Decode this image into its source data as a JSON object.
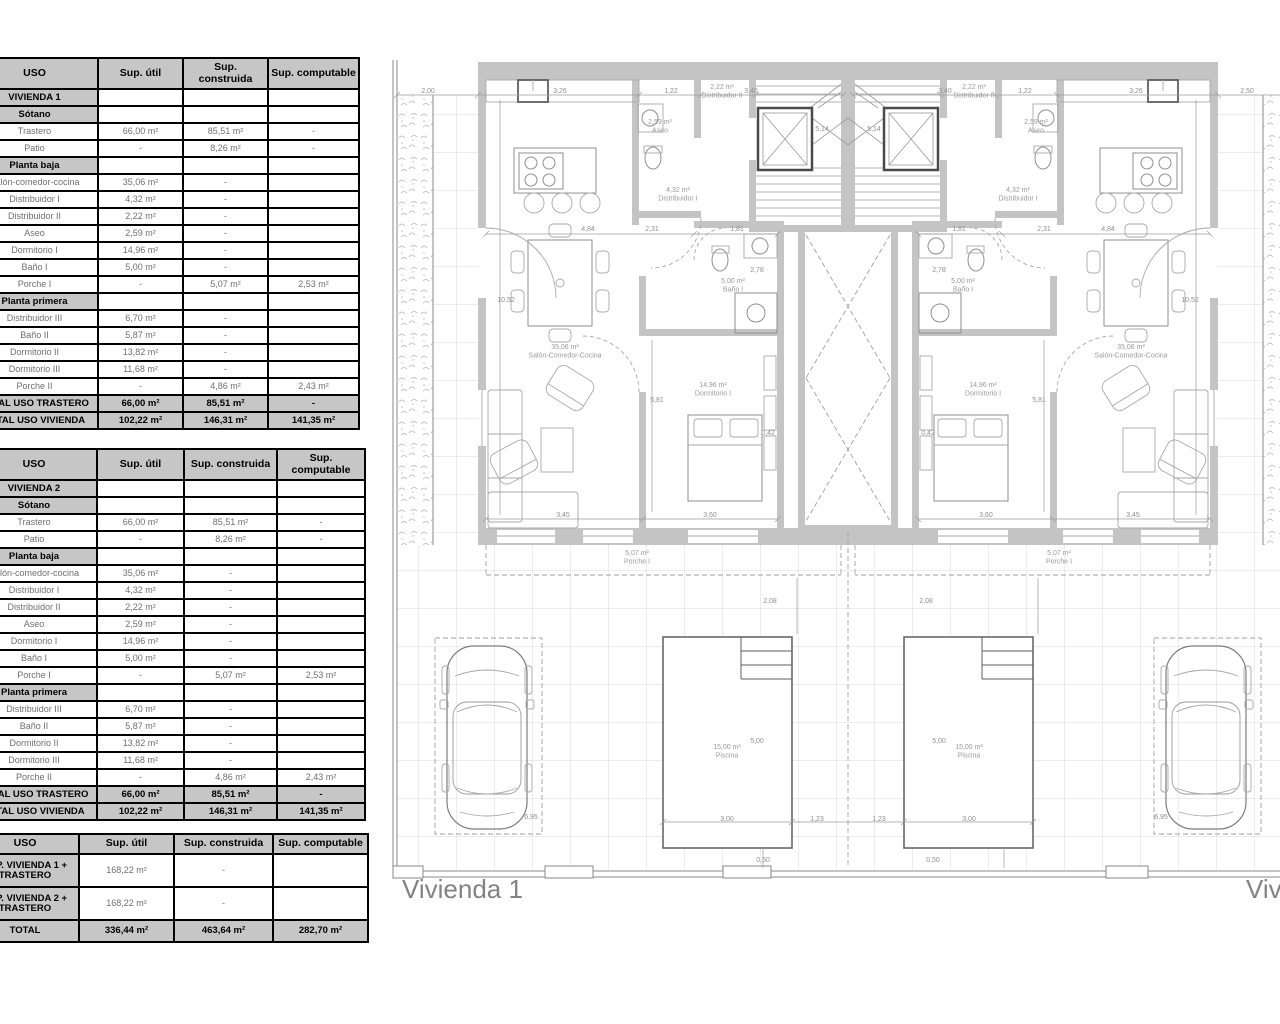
{
  "tables": {
    "headers": [
      "USO",
      "Sup. útil",
      "Sup. construida",
      "Sup. computable"
    ],
    "vivienda1": {
      "rows": [
        {
          "type": "title",
          "label": "VIVIENDA 1",
          "util": "",
          "construida": "",
          "computable": ""
        },
        {
          "type": "section",
          "label": "Sótano",
          "util": "",
          "construida": "",
          "computable": ""
        },
        {
          "type": "data",
          "label": "Trastero",
          "util": "66,00 m²",
          "construida": "85,51 m²",
          "computable": "-"
        },
        {
          "type": "data",
          "label": "Patio",
          "util": "-",
          "construida": "8,26 m²",
          "computable": "-"
        },
        {
          "type": "section",
          "label": "Planta baja",
          "util": "",
          "construida": "",
          "computable": ""
        },
        {
          "type": "data",
          "label": "Salón-comedor-cocina",
          "util": "35,06 m²",
          "construida": "-",
          "computable": ""
        },
        {
          "type": "data",
          "label": "Distribuidor I",
          "util": "4,32 m²",
          "construida": "-",
          "computable": ""
        },
        {
          "type": "data",
          "label": "Distribuidor II",
          "util": "2,22 m²",
          "construida": "-",
          "computable": ""
        },
        {
          "type": "data",
          "label": "Aseo",
          "util": "2,59 m²",
          "construida": "-",
          "computable": ""
        },
        {
          "type": "data",
          "label": "Dormitorio I",
          "util": "14,96 m²",
          "construida": "-",
          "computable": ""
        },
        {
          "type": "data",
          "label": "Baño I",
          "util": "5,00 m²",
          "construida": "-",
          "computable": ""
        },
        {
          "type": "data",
          "label": "Porche I",
          "util": "-",
          "construida": "5,07 m²",
          "computable": "2,53 m²"
        },
        {
          "type": "section",
          "label": "Planta primera",
          "util": "",
          "construida": "",
          "computable": ""
        },
        {
          "type": "data",
          "label": "Distribuidor III",
          "util": "6,70 m²",
          "construida": "-",
          "computable": ""
        },
        {
          "type": "data",
          "label": "Baño II",
          "util": "5,87 m²",
          "construida": "-",
          "computable": ""
        },
        {
          "type": "data",
          "label": "Dormitorio II",
          "util": "13,82 m²",
          "construida": "-",
          "computable": ""
        },
        {
          "type": "data",
          "label": "Dormitorio III",
          "util": "11,68 m²",
          "construida": "-",
          "computable": ""
        },
        {
          "type": "data",
          "label": "Porche II",
          "util": "-",
          "construida": "4,86 m²",
          "computable": "2,43 m²"
        },
        {
          "type": "total",
          "label": "TOTAL USO TRASTERO",
          "util": "66,00 m²",
          "construida": "85,51 m²",
          "computable": "-"
        },
        {
          "type": "total",
          "label": "TOTAL USO VIVIENDA",
          "util": "102,22 m²",
          "construida": "146,31 m²",
          "computable": "141,35 m²"
        }
      ]
    },
    "vivienda2": {
      "rows": [
        {
          "type": "title",
          "label": "VIVIENDA 2",
          "util": "",
          "construida": "",
          "computable": ""
        },
        {
          "type": "section",
          "label": "Sótano",
          "util": "",
          "construida": "",
          "computable": ""
        },
        {
          "type": "data",
          "label": "Trastero",
          "util": "66,00 m²",
          "construida": "85,51 m²",
          "computable": "-"
        },
        {
          "type": "data",
          "label": "Patio",
          "util": "-",
          "construida": "8,26 m²",
          "computable": "-"
        },
        {
          "type": "section",
          "label": "Planta baja",
          "util": "",
          "construida": "",
          "computable": ""
        },
        {
          "type": "data",
          "label": "Salón-comedor-cocina",
          "util": "35,06 m²",
          "construida": "-",
          "computable": ""
        },
        {
          "type": "data",
          "label": "Distribuidor I",
          "util": "4,32 m²",
          "construida": "-",
          "computable": ""
        },
        {
          "type": "data",
          "label": "Distribuidor II",
          "util": "2,22 m²",
          "construida": "-",
          "computable": ""
        },
        {
          "type": "data",
          "label": "Aseo",
          "util": "2,59 m²",
          "construida": "-",
          "computable": ""
        },
        {
          "type": "data",
          "label": "Dormitorio I",
          "util": "14,96 m²",
          "construida": "-",
          "computable": ""
        },
        {
          "type": "data",
          "label": "Baño I",
          "util": "5,00 m²",
          "construida": "-",
          "computable": ""
        },
        {
          "type": "data",
          "label": "Porche I",
          "util": "-",
          "construida": "5,07 m²",
          "computable": "2,53 m²"
        },
        {
          "type": "section",
          "label": "Planta primera",
          "util": "",
          "construida": "",
          "computable": ""
        },
        {
          "type": "data",
          "label": "Distribuidor III",
          "util": "6,70 m²",
          "construida": "-",
          "computable": ""
        },
        {
          "type": "data",
          "label": "Baño II",
          "util": "5,87 m²",
          "construida": "-",
          "computable": ""
        },
        {
          "type": "data",
          "label": "Dormitorio II",
          "util": "13,82 m²",
          "construida": "-",
          "computable": ""
        },
        {
          "type": "data",
          "label": "Dormitorio III",
          "util": "11,68 m²",
          "construida": "-",
          "computable": ""
        },
        {
          "type": "data",
          "label": "Porche II",
          "util": "-",
          "construida": "4,86 m²",
          "computable": "2,43 m²"
        },
        {
          "type": "total",
          "label": "TOTAL USO TRASTERO",
          "util": "66,00 m²",
          "construida": "85,51 m²",
          "computable": "-"
        },
        {
          "type": "total",
          "label": "TOTAL USO VIVIENDA",
          "util": "102,22 m²",
          "construida": "146,31 m²",
          "computable": "141,35 m²"
        }
      ]
    },
    "totals": {
      "rows": [
        {
          "type": "total-label",
          "label": "SUP. VIVIENDA 1 + TRASTERO",
          "util": "168,22 m²",
          "construida": "-",
          "computable": ""
        },
        {
          "type": "total-label",
          "label": "SUP. VIVIENDA 2 + TRASTERO",
          "util": "168,22 m²",
          "construida": "-",
          "computable": ""
        },
        {
          "type": "total",
          "label": "TOTAL",
          "util": "336,44 m²",
          "construida": "463,64  m²",
          "computable": "282,70  m²"
        }
      ]
    }
  },
  "plan": {
    "caption_house1": "Vivienda 1",
    "caption_house2": "Vivienda 2",
    "labels": [
      {
        "t": "2,00",
        "x": 428,
        "y": 93,
        "c": "dim"
      },
      {
        "t": "3,26",
        "x": 560,
        "y": 93,
        "c": "dim"
      },
      {
        "t": "1,22",
        "x": 671,
        "y": 93,
        "c": "dim"
      },
      {
        "t": "2,22 m²\nDistribuidor II",
        "x": 722,
        "y": 89,
        "c": "room",
        "s": 6.5
      },
      {
        "t": "3,40",
        "x": 751,
        "y": 93,
        "c": "dim"
      },
      {
        "t": "5,14",
        "x": 822,
        "y": 131,
        "c": "dim"
      },
      {
        "t": "5,14",
        "x": 874,
        "y": 131,
        "c": "dim"
      },
      {
        "t": "3,40",
        "x": 945,
        "y": 93,
        "c": "dim"
      },
      {
        "t": "2,22 m²\nDistribuidor II",
        "x": 974,
        "y": 89,
        "c": "room",
        "s": 6.5
      },
      {
        "t": "1,22",
        "x": 1025,
        "y": 93,
        "c": "dim"
      },
      {
        "t": "3,26",
        "x": 1136,
        "y": 93,
        "c": "dim"
      },
      {
        "t": "2,50",
        "x": 1247,
        "y": 93,
        "c": "dim"
      },
      {
        "t": "2,59 m²\nAseo",
        "x": 660,
        "y": 124,
        "c": "room",
        "s": 6.5
      },
      {
        "t": "2,59 m²\nAseo",
        "x": 1036,
        "y": 124,
        "c": "room",
        "s": 6.5
      },
      {
        "t": "4,32 m²\nDistribuidor I",
        "x": 678,
        "y": 192,
        "c": "room",
        "s": 6.5
      },
      {
        "t": "4,32 m²\nDistribuidor I",
        "x": 1018,
        "y": 192,
        "c": "room",
        "s": 6.5
      },
      {
        "t": "4,84",
        "x": 588,
        "y": 231,
        "c": "dim"
      },
      {
        "t": "2,31",
        "x": 652,
        "y": 231,
        "c": "dim"
      },
      {
        "t": "1,81",
        "x": 737,
        "y": 231,
        "c": "dim"
      },
      {
        "t": "1,81",
        "x": 959,
        "y": 231,
        "c": "dim"
      },
      {
        "t": "2,31",
        "x": 1044,
        "y": 231,
        "c": "dim"
      },
      {
        "t": "4,84",
        "x": 1108,
        "y": 231,
        "c": "dim"
      },
      {
        "t": "5,00 m²\nBaño I",
        "x": 733,
        "y": 283,
        "c": "room",
        "s": 6.5
      },
      {
        "t": "2,78",
        "x": 757,
        "y": 272,
        "c": "dim",
        "s": 6
      },
      {
        "t": "2,78",
        "x": 939,
        "y": 272,
        "c": "dim",
        "s": 6
      },
      {
        "t": "5,00 m²\nBaño I",
        "x": 963,
        "y": 283,
        "c": "room",
        "s": 6.5
      },
      {
        "t": "10,52",
        "x": 506,
        "y": 302,
        "c": "dim"
      },
      {
        "t": "10,52",
        "x": 1190,
        "y": 302,
        "c": "dim"
      },
      {
        "t": "35,06 m²\nSalón-Comedor-Cocina",
        "x": 565,
        "y": 349,
        "c": "room"
      },
      {
        "t": "35,06 m²\nSalón-Comedor-Cocina",
        "x": 1131,
        "y": 349,
        "c": "room"
      },
      {
        "t": "14,96 m²\nDormitorio I",
        "x": 713,
        "y": 387,
        "c": "room"
      },
      {
        "t": "14,96 m²\nDormitorio I",
        "x": 983,
        "y": 387,
        "c": "room"
      },
      {
        "t": "5,81",
        "x": 657,
        "y": 402,
        "c": "dim"
      },
      {
        "t": "5,81",
        "x": 1039,
        "y": 402,
        "c": "dim"
      },
      {
        "t": "0,42",
        "x": 768,
        "y": 435,
        "c": "dim",
        "s": 6
      },
      {
        "t": "0,42",
        "x": 928,
        "y": 435,
        "c": "dim",
        "s": 6
      },
      {
        "t": "3,45",
        "x": 563,
        "y": 517,
        "c": "dim"
      },
      {
        "t": "3,60",
        "x": 710,
        "y": 517,
        "c": "dim"
      },
      {
        "t": "3,60",
        "x": 986,
        "y": 517,
        "c": "dim"
      },
      {
        "t": "3,45",
        "x": 1133,
        "y": 517,
        "c": "dim"
      },
      {
        "t": "5,07 m²\nPorche I",
        "x": 637,
        "y": 555,
        "c": "room"
      },
      {
        "t": "5,07 m²\nPorche I",
        "x": 1059,
        "y": 555,
        "c": "room"
      },
      {
        "t": "2,08",
        "x": 770,
        "y": 603,
        "c": "dim"
      },
      {
        "t": "2,08",
        "x": 926,
        "y": 603,
        "c": "dim"
      },
      {
        "t": "5,00",
        "x": 757,
        "y": 743,
        "c": "dim"
      },
      {
        "t": "5,00",
        "x": 939,
        "y": 743,
        "c": "dim"
      },
      {
        "t": "15,00 m²\nPiscina",
        "x": 727,
        "y": 749,
        "c": "room"
      },
      {
        "t": "15,00 m²\nPiscina",
        "x": 969,
        "y": 749,
        "c": "room"
      },
      {
        "t": "3,00",
        "x": 727,
        "y": 821,
        "c": "dim"
      },
      {
        "t": "1,23",
        "x": 817,
        "y": 821,
        "c": "dim"
      },
      {
        "t": "1,23",
        "x": 879,
        "y": 821,
        "c": "dim"
      },
      {
        "t": "3,00",
        "x": 969,
        "y": 821,
        "c": "dim"
      },
      {
        "t": "6,95",
        "x": 531,
        "y": 819,
        "c": "dim"
      },
      {
        "t": "6,95",
        "x": 1161,
        "y": 819,
        "c": "dim"
      },
      {
        "t": "0,50",
        "x": 763,
        "y": 862,
        "c": "dim"
      },
      {
        "t": "0,50",
        "x": 933,
        "y": 862,
        "c": "dim"
      }
    ]
  }
}
